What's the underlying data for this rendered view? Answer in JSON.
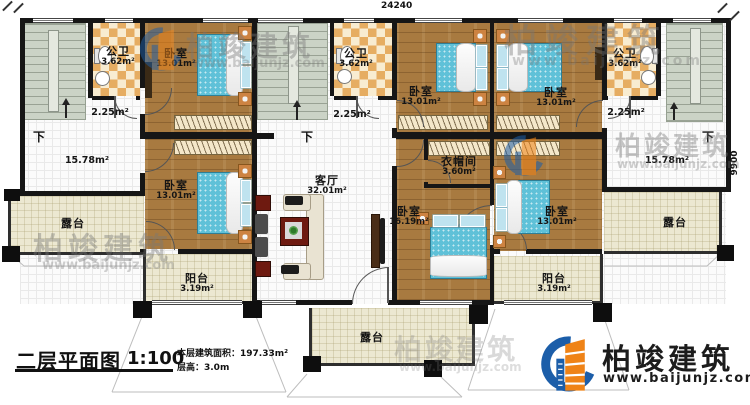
{
  "title_block": {
    "drawing_name": "二层平面图",
    "scale": "1:100",
    "area_line": "本层建筑面积：197.33m²",
    "height_line": "层高：3.0m"
  },
  "dimensions": {
    "top": "24240",
    "right": "9900"
  },
  "brand": {
    "name": "柏竣建筑",
    "url": "www.baijunjz.com",
    "logo_blue": "#1c5ea9",
    "logo_orange": "#ef8317"
  },
  "stairs": {
    "down_label": "下"
  },
  "rooms": {
    "bath_left": {
      "name": "公卫",
      "area": "3.62m²"
    },
    "bath_mid": {
      "name": "公卫",
      "area": "3.62m²"
    },
    "bath_right": {
      "name": "公卫",
      "area": "3.62m²"
    },
    "hall_left": {
      "area": "2.25m²"
    },
    "hall_mid": {
      "area": "2.25m²"
    },
    "hall_right": {
      "area": "2.25m²"
    },
    "lobby_left": {
      "area": "15.78m²"
    },
    "lobby_right": {
      "area": "15.78m²"
    },
    "bedroom_top_left": {
      "name": "卧室",
      "area": "13.01m²"
    },
    "bedroom_bottom_left": {
      "name": "卧室",
      "area": "13.01m²"
    },
    "bedroom_top_mid": {
      "name": "卧室",
      "area": "13.01m²"
    },
    "bedroom_top_right": {
      "name": "卧室",
      "area": "13.01m²"
    },
    "bedroom_master": {
      "name": "卧室",
      "area": "16.19m²"
    },
    "bedroom_bottom_right": {
      "name": "卧室",
      "area": "13.01m²"
    },
    "living": {
      "name": "客厅",
      "area": "32.01m²"
    },
    "cloakroom": {
      "name": "衣帽间",
      "area": "3.60m²"
    },
    "balcony_left": {
      "name": "阳台",
      "area": "3.19m²"
    },
    "balcony_right": {
      "name": "阳台",
      "area": "3.19m²"
    },
    "terrace_left": {
      "name": "露台"
    },
    "terrace_right": {
      "name": "露台"
    },
    "terrace_bottom": {
      "name": "露台"
    }
  }
}
